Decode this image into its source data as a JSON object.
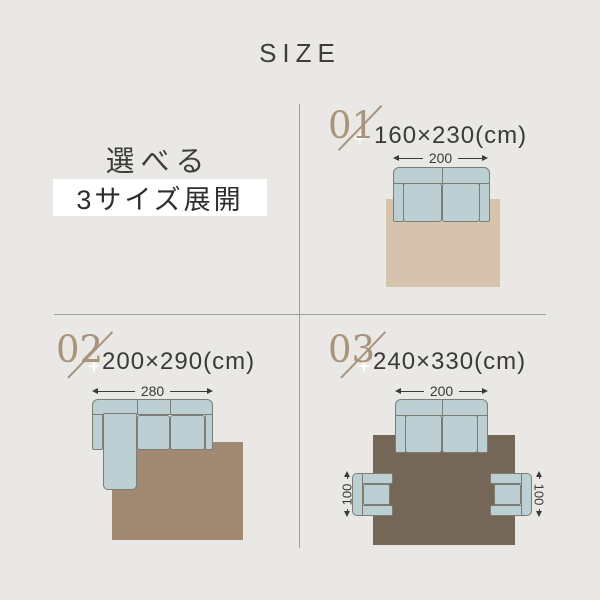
{
  "page": {
    "title": "SIZE",
    "background": "#e9e8e4"
  },
  "intro": {
    "line1": "選べる",
    "line2": "3サイズ展開"
  },
  "colors": {
    "accent_tan": "#a8937d",
    "text_dark": "#3a3a3a",
    "sofa_fill": "#bccfd3",
    "sofa_outline": "#7c7e75",
    "rug_01_beige": "#d5c3ad",
    "rug_02_taupe": "#a18a74",
    "rug_03_brown": "#756757",
    "divider_gray": "#9e9e9c",
    "highlight_bg": "#ffffff"
  },
  "sections": [
    {
      "number": "01",
      "size_label": "160×230(cm)",
      "sofa_width_label": "200"
    },
    {
      "number": "02",
      "size_label": "200×290(cm)",
      "sofa_width_label": "280"
    },
    {
      "number": "03",
      "size_label": "240×330(cm)",
      "sofa_width_label": "200",
      "chair_depth_label": "100"
    }
  ]
}
